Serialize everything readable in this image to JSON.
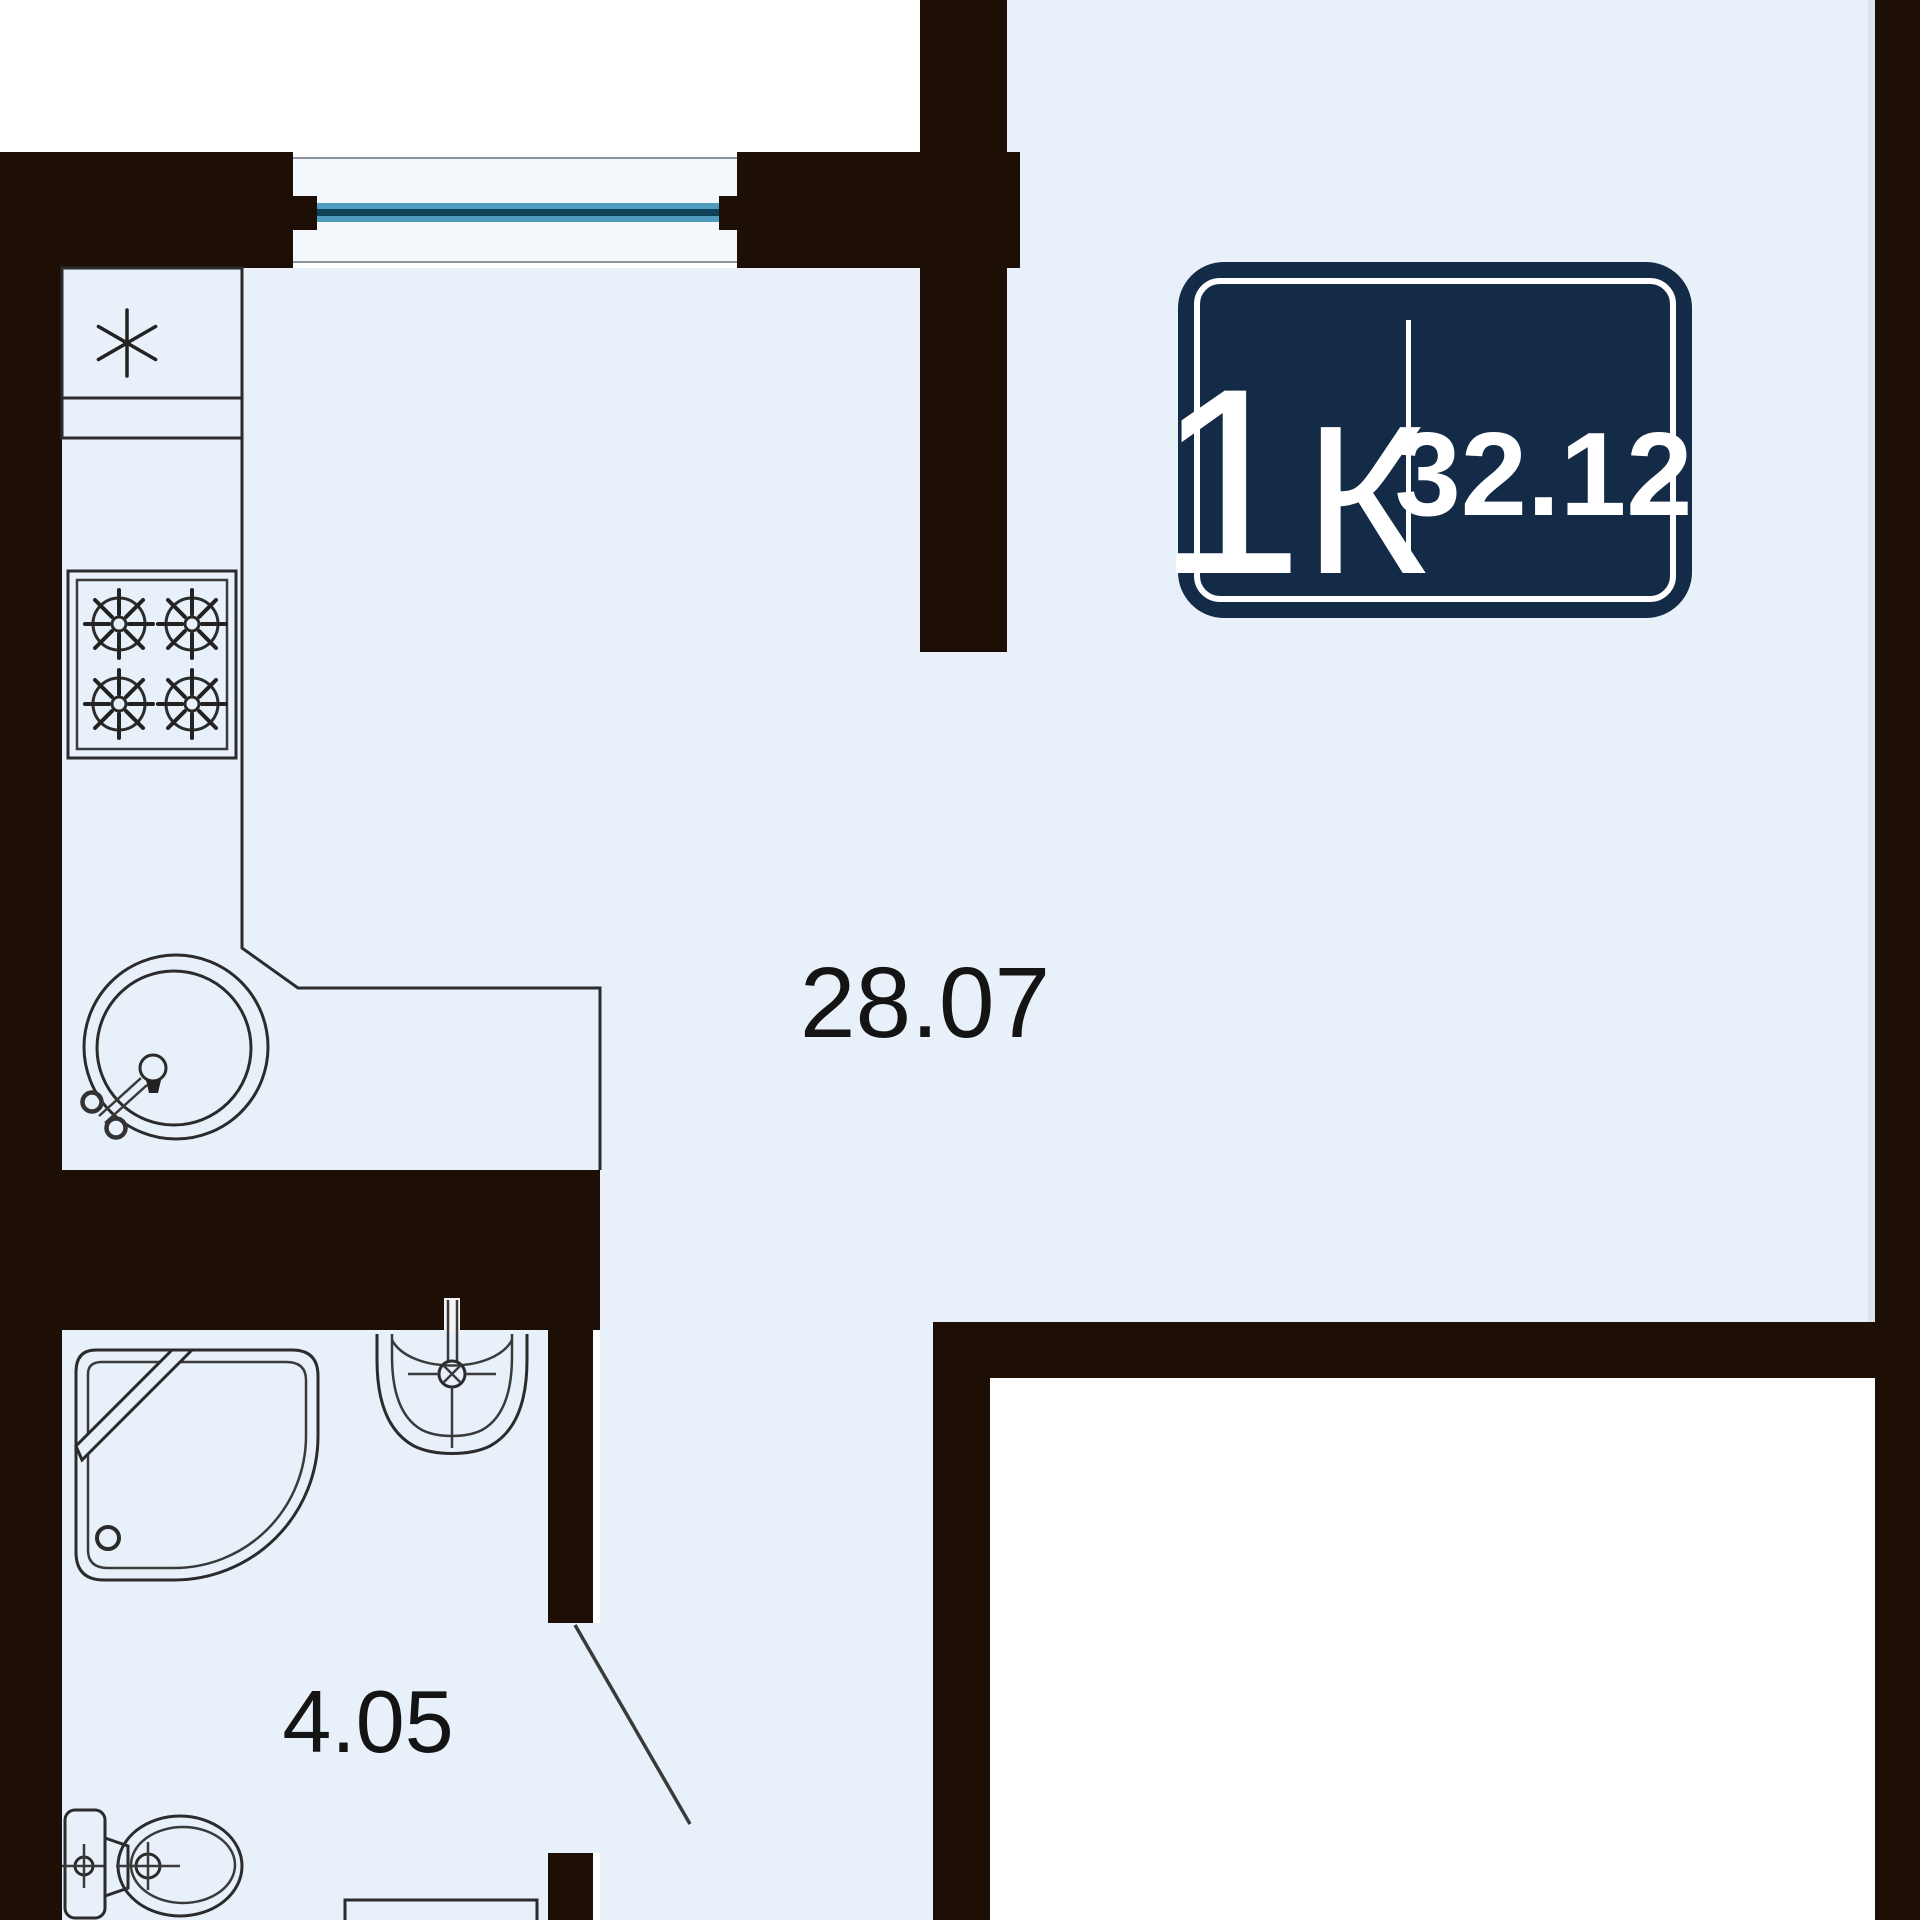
{
  "page": {
    "type": "apartment floor plan",
    "description": "Plan of a 1-room apartment with kitchen-living room, bathroom and entry corridor"
  },
  "badge": {
    "rooms_count": "1",
    "rooms_letter": "К",
    "area": "32.12",
    "bg_color": "#132b47",
    "text_color": "#ffffff"
  },
  "rooms": {
    "living": {
      "area_label": "28.07"
    },
    "bathroom": {
      "area_label": "4.05"
    }
  },
  "colors": {
    "wall": "#1d0e06",
    "floor": "#e8f0fa",
    "exterior": "#ffffff",
    "window_sill": "#f3f8fd",
    "window_glass": "#4f9cbf",
    "window_glass_core": "#0d4259",
    "fixture_outline": "#2b2b2b",
    "label_text": "#141414"
  },
  "icons": {
    "fridge": "asterisk-symbol",
    "stove": "four-burner-wheel-symbols",
    "kitchen_sink": "round-sink-with-tap",
    "shower": "quarter-round-shower-cabin",
    "bath_sink": "half-round-wall-sink-with-tap",
    "toilet": "toilet-with-cistern",
    "door": "door-leaf-line",
    "window": "double-glazed-window"
  }
}
